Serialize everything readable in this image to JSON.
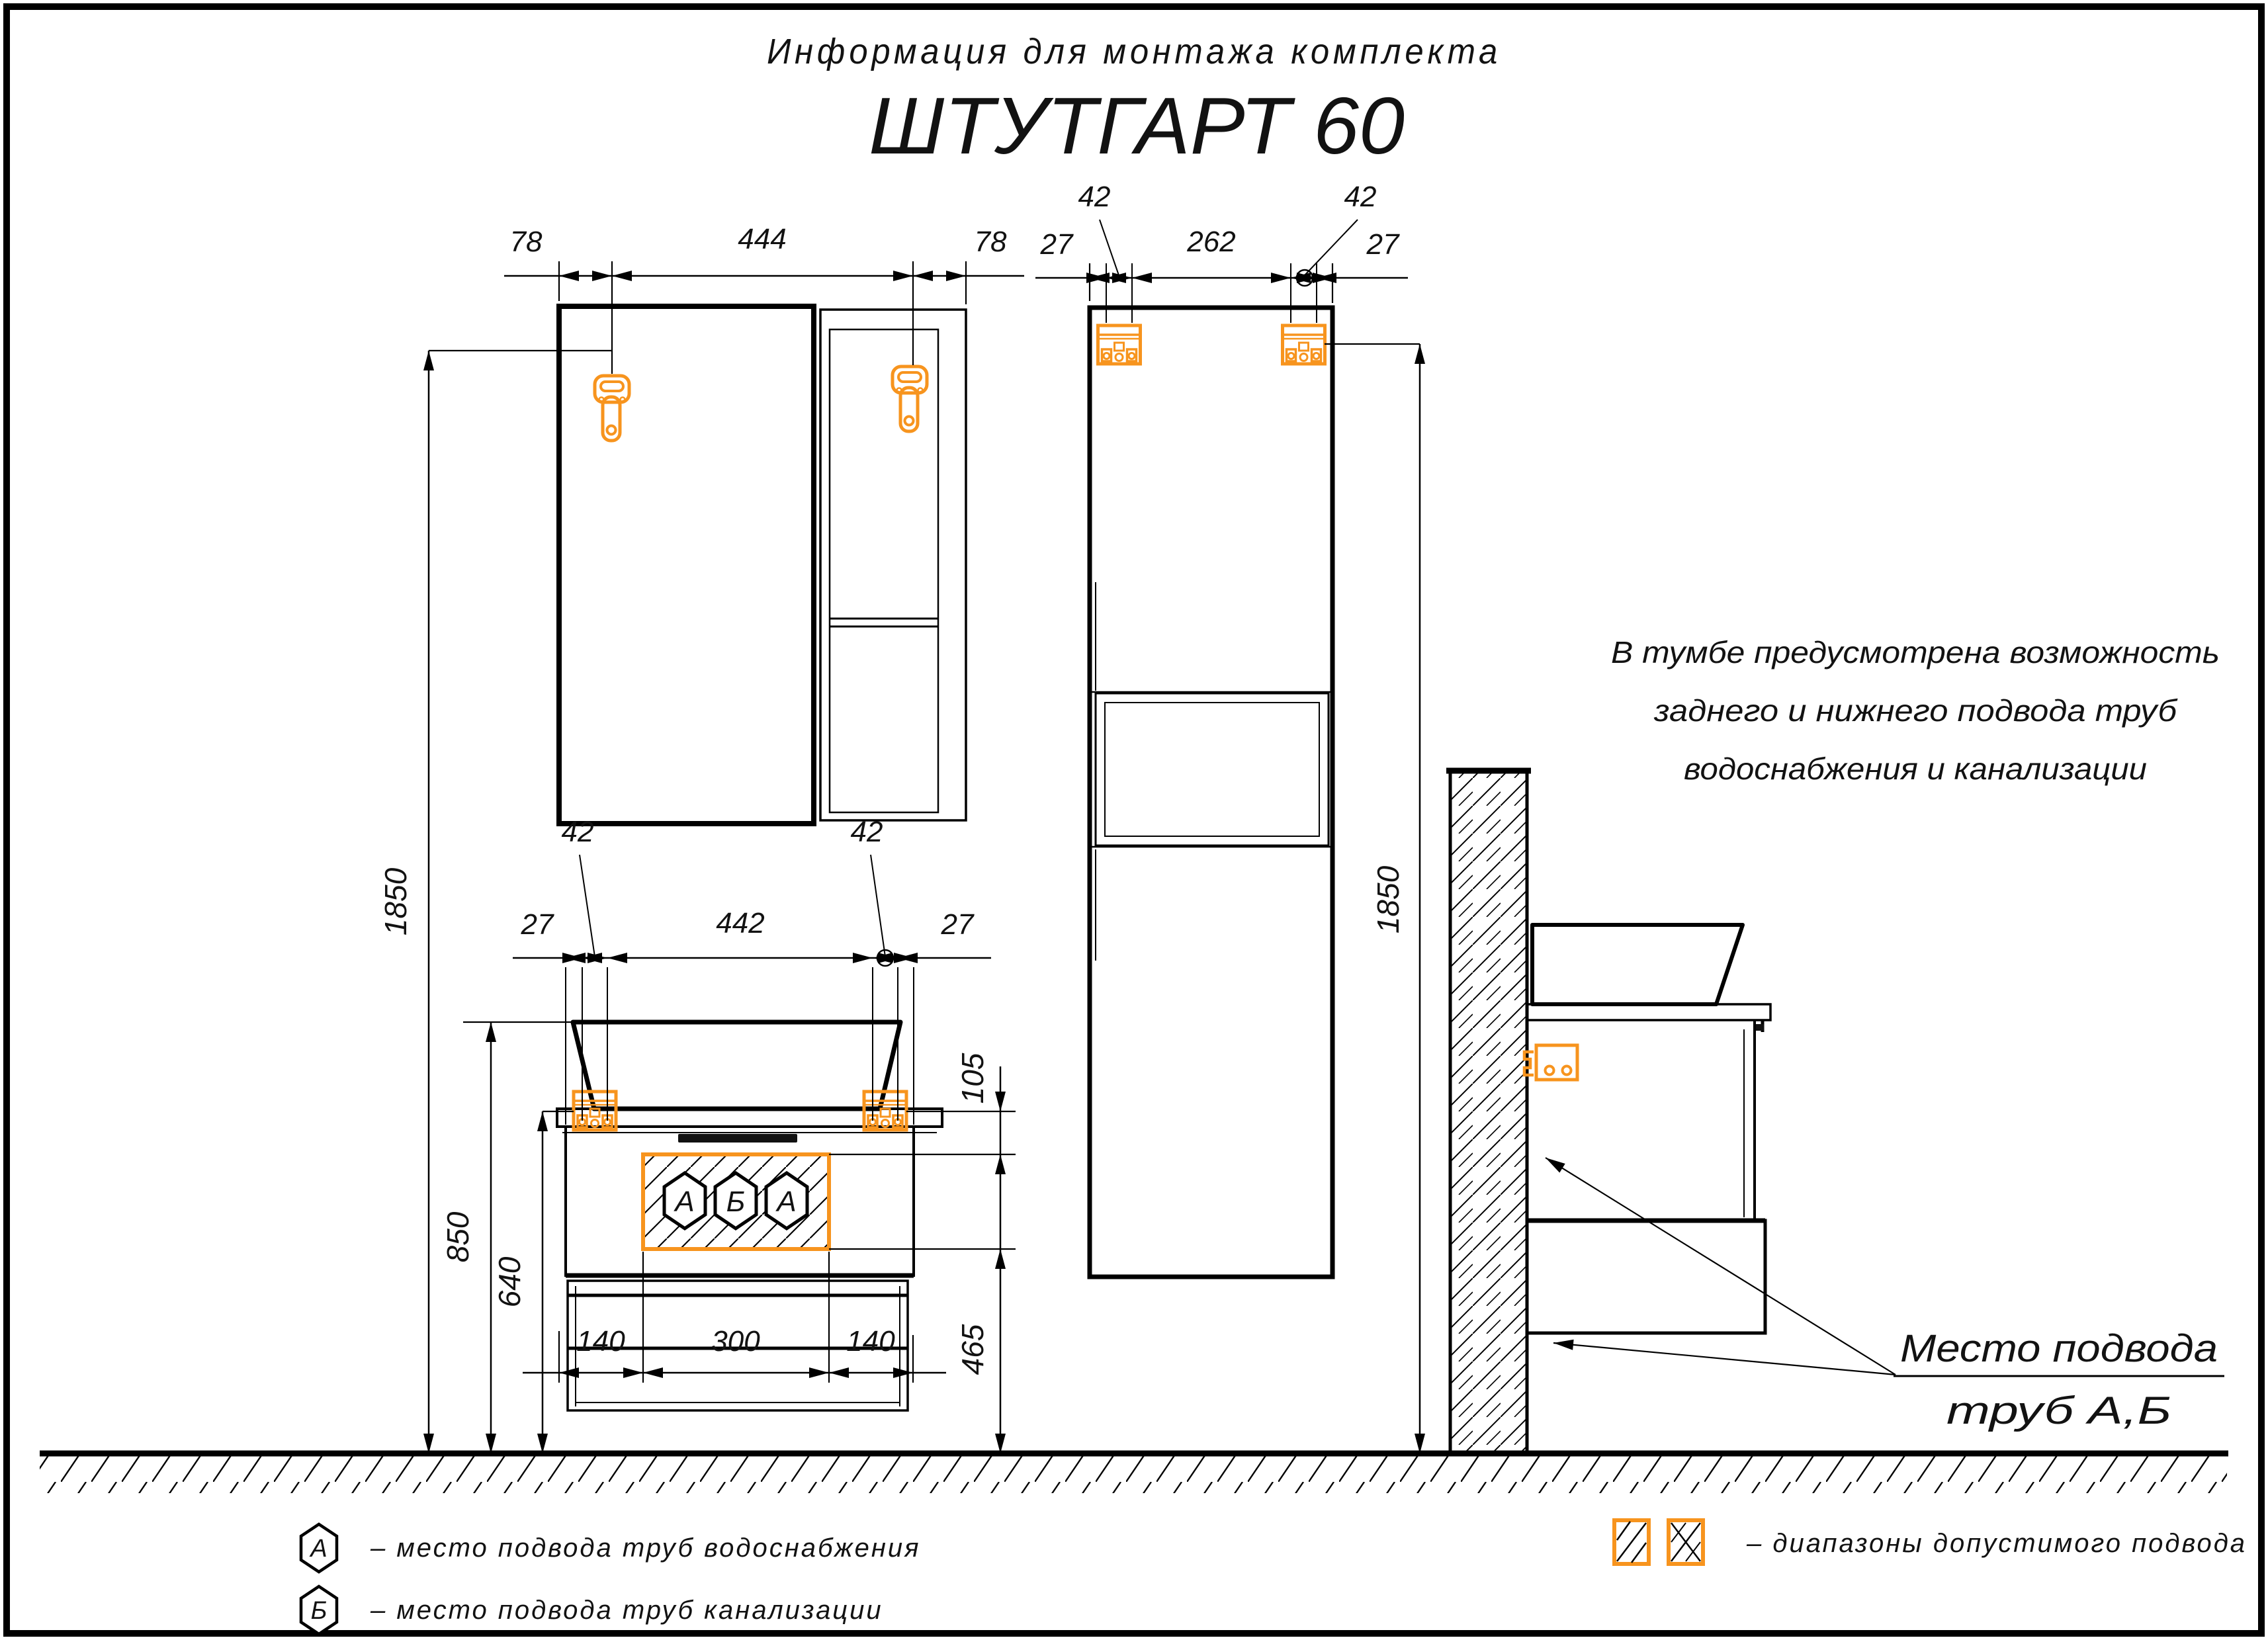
{
  "title": {
    "heading": "Информация для монтажа комплекта",
    "product": "ШТУТГАРТ 60"
  },
  "note": {
    "line1": "В тумбе предусмотрена возможность",
    "line2": "заднего и нижнего подвода труб",
    "line3": "водоснабжения и канализации"
  },
  "mirror_view": {
    "dim_left": "78",
    "dim_center": "444",
    "dim_right": "78",
    "dim_height": "1850"
  },
  "tall_view": {
    "dim_27_left": "27",
    "dim_42_left": "42",
    "dim_center": "262",
    "dim_42_right": "42",
    "dim_27_right": "27",
    "dim_height": "1850"
  },
  "vanity_view": {
    "dim_27_left": "27",
    "dim_42_left": "42",
    "dim_center": "442",
    "dim_42_right": "42",
    "dim_27_right": "27",
    "dim_105": "105",
    "dim_465": "465",
    "dim_bottom_left": "140",
    "dim_bottom_center": "300",
    "dim_bottom_right": "140",
    "dim_850": "850",
    "dim_640": "640",
    "port_labels": [
      "А",
      "Б",
      "А"
    ]
  },
  "side_view": {
    "callout_line1": "Место подвода",
    "callout_line2": "труб А,Б"
  },
  "legend": {
    "water": {
      "symbol": "А",
      "label": "–  место подвода труб водоснабжения"
    },
    "sewer": {
      "symbol": "Б",
      "label": "–  место подвода труб канализации"
    },
    "range": {
      "label": "–  диапазоны допустимого подвода"
    }
  },
  "colors": {
    "accent": "#F7941E",
    "line": "#000000"
  }
}
